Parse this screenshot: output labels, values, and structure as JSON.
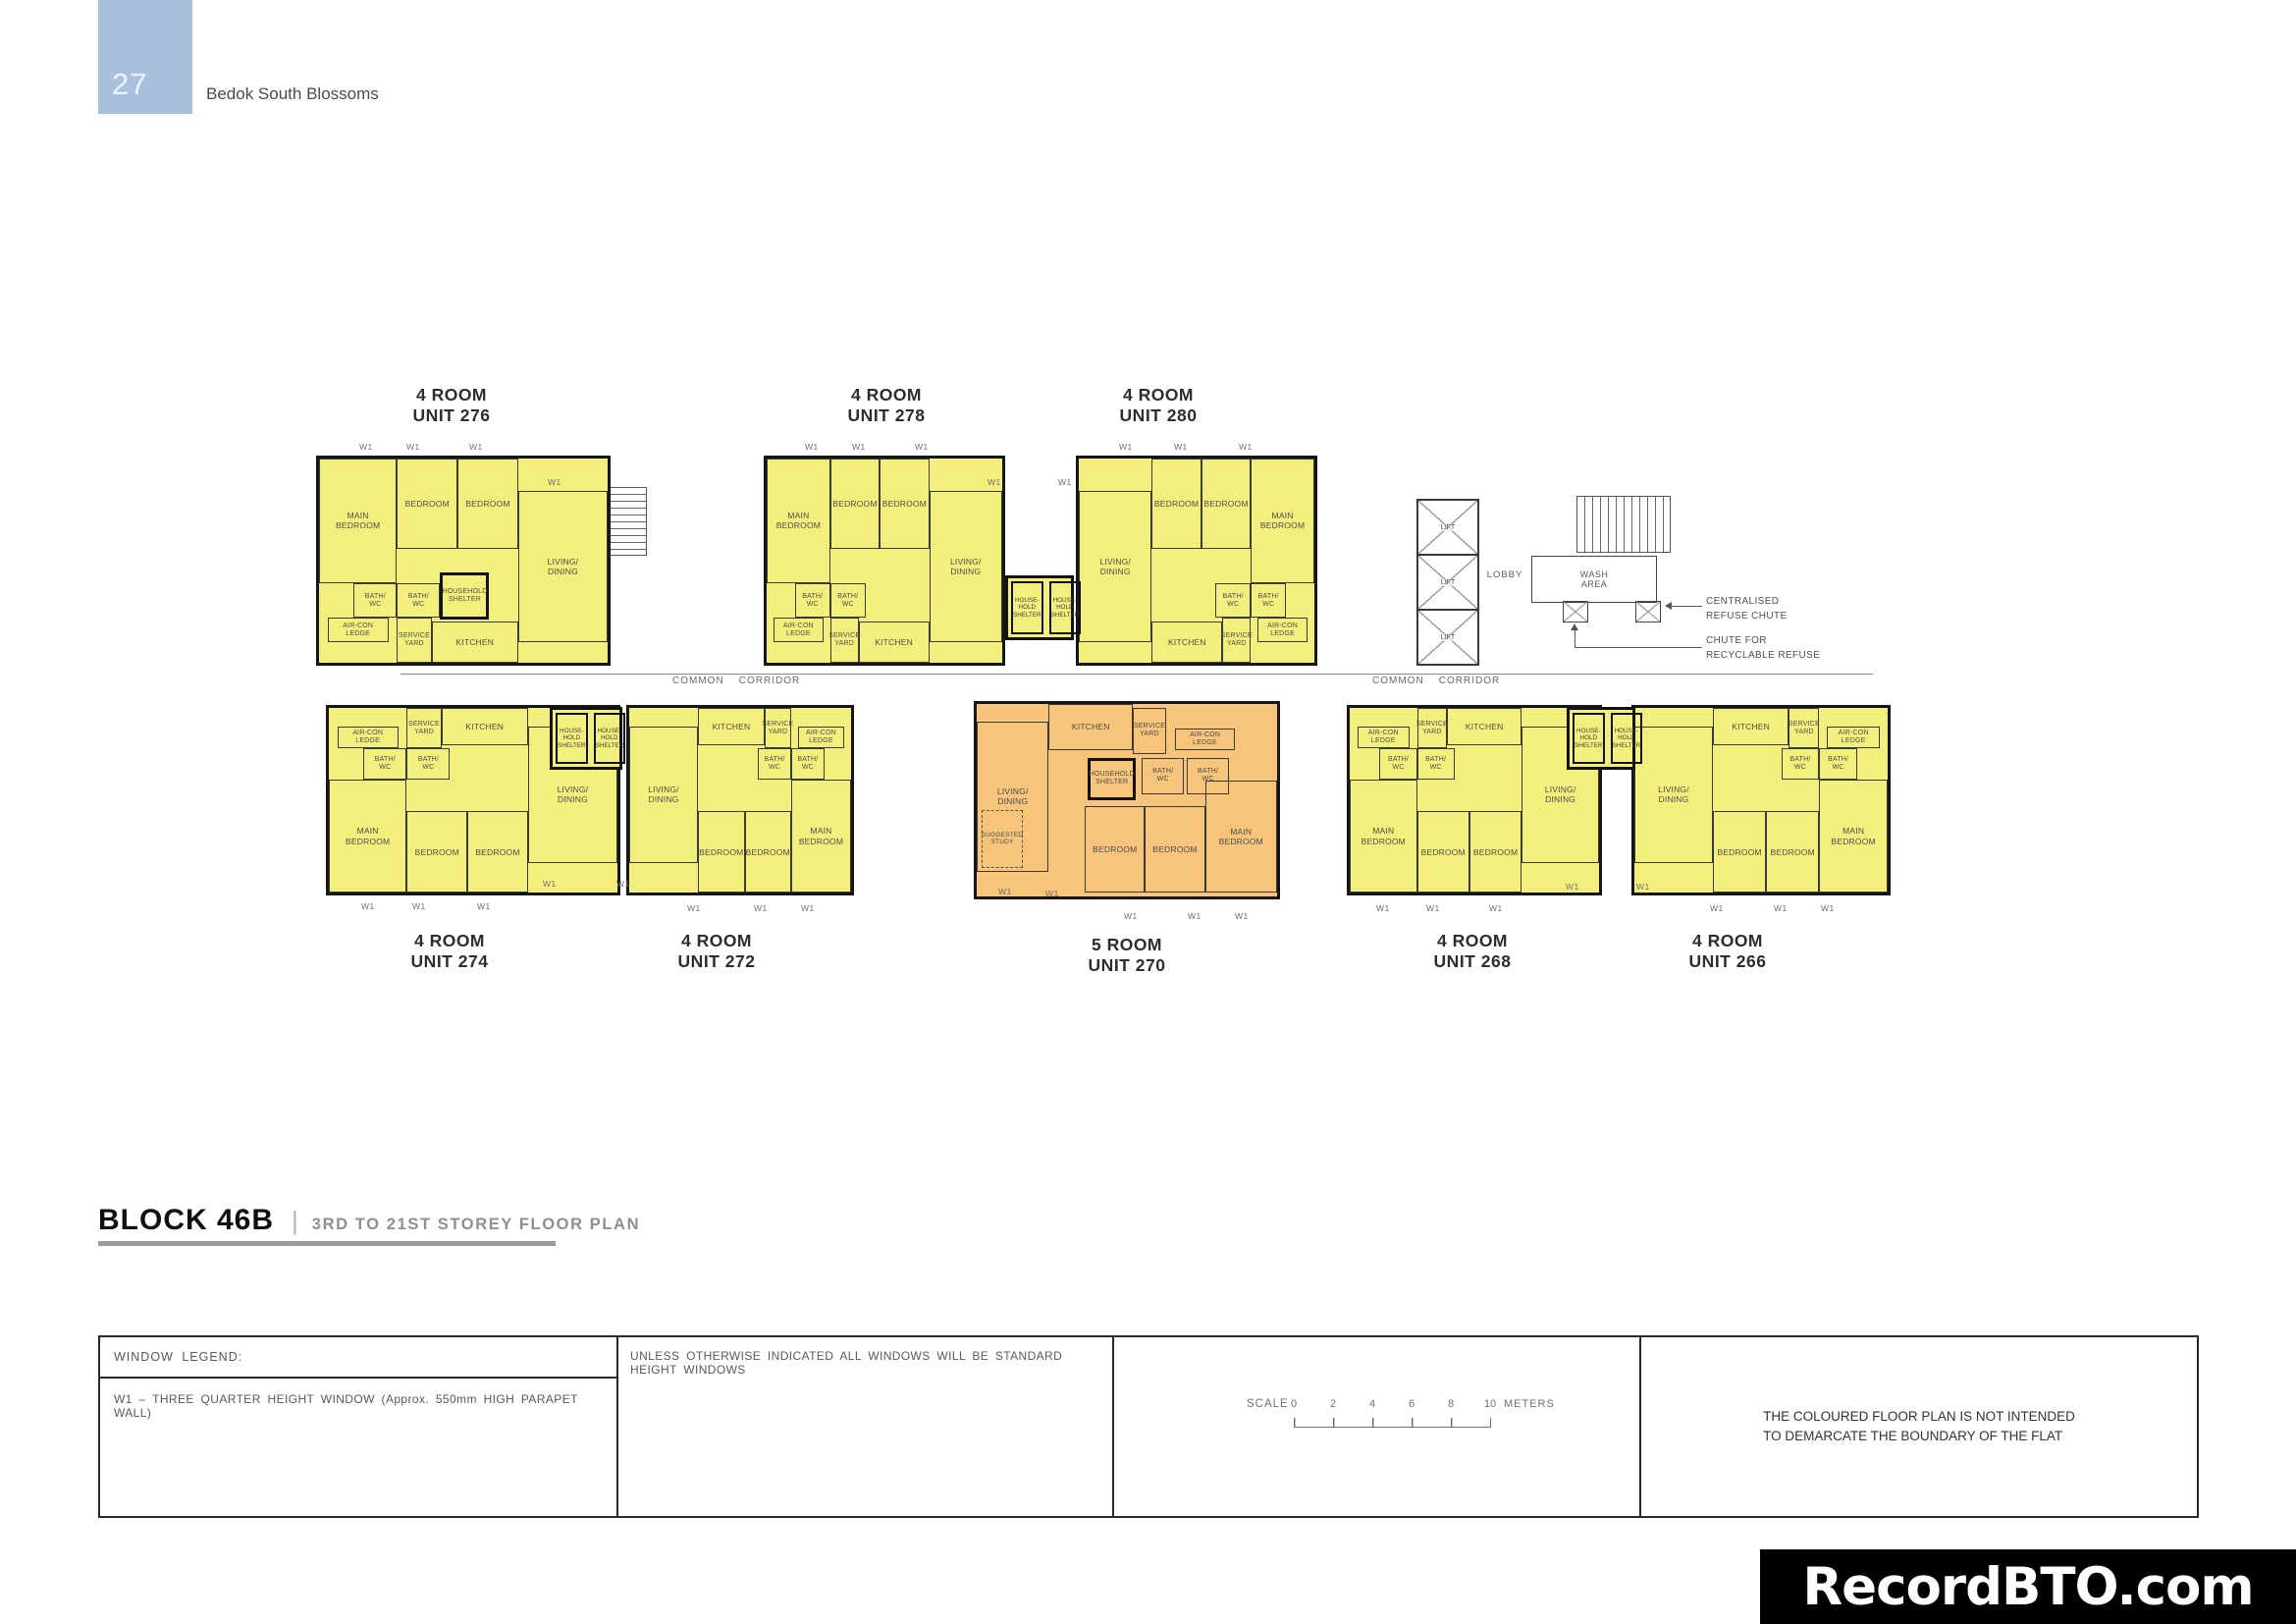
{
  "page": {
    "number": "27",
    "title": "Bedok South Blossoms"
  },
  "plan": {
    "units": [
      {
        "id": "276",
        "type": "4 ROOM",
        "unit": "UNIT 276"
      },
      {
        "id": "278",
        "type": "4 ROOM",
        "unit": "UNIT 278"
      },
      {
        "id": "280",
        "type": "4 ROOM",
        "unit": "UNIT 280"
      },
      {
        "id": "274",
        "type": "4 ROOM",
        "unit": "UNIT 274"
      },
      {
        "id": "272",
        "type": "4 ROOM",
        "unit": "UNIT 272"
      },
      {
        "id": "270",
        "type": "5 ROOM",
        "unit": "UNIT 270"
      },
      {
        "id": "268",
        "type": "4 ROOM",
        "unit": "UNIT 268"
      },
      {
        "id": "266",
        "type": "4 ROOM",
        "unit": "UNIT 266"
      }
    ],
    "room_labels": {
      "main_bedroom": "MAIN\nBEDROOM",
      "bedroom": "BEDROOM",
      "living_dining": "LIVING/\nDINING",
      "bath_wc": "BATH/\nWC",
      "aircon_ledge": "AIR-CON\nLEDGE",
      "service_yard": "SERVICE\nYARD",
      "kitchen": "KITCHEN",
      "household_shelter": "HOUSEHOLD\nSHELTER",
      "household_shelter_split": "HOUSE-\nHOLD\nSHELTER",
      "suggested_study": "SUGGESTED\nSTUDY"
    },
    "labels": {
      "lift": "LIFT",
      "lobby": "LOBBY",
      "wash_area": "WASH\nAREA",
      "common_corridor": "COMMON    CORRIDOR",
      "centralised_refuse_chute": "CENTRALISED\nREFUSE CHUTE",
      "recyclable_chute": "CHUTE FOR\nRECYCLABLE REFUSE",
      "w1": "W1"
    },
    "colors": {
      "four_room_fill": "#f3ef7c",
      "five_room_fill": "#f6c47a",
      "wall": "#161616"
    }
  },
  "title_block": {
    "block": "BLOCK 46B",
    "divider": "|",
    "subtitle": "3RD TO 21ST STOREY FLOOR PLAN"
  },
  "legend": {
    "window_legend_heading": "WINDOW LEGEND:",
    "w1_definition": "W1 – THREE QUARTER HEIGHT WINDOW (Approx. 550mm HIGH PARAPET WALL)",
    "standard_windows_note": "UNLESS OTHERWISE INDICATED ALL WINDOWS WILL BE STANDARD HEIGHT WINDOWS",
    "scale_label": "SCALE",
    "scale_ticks": [
      "0",
      "2",
      "4",
      "6",
      "8",
      "10"
    ],
    "scale_unit": "METERS",
    "coloured_plan_note": "THE COLOURED FLOOR PLAN IS NOT INTENDED\nTO DEMARCATE THE BOUNDARY OF THE FLAT"
  },
  "watermark": "RecordBTO.com"
}
